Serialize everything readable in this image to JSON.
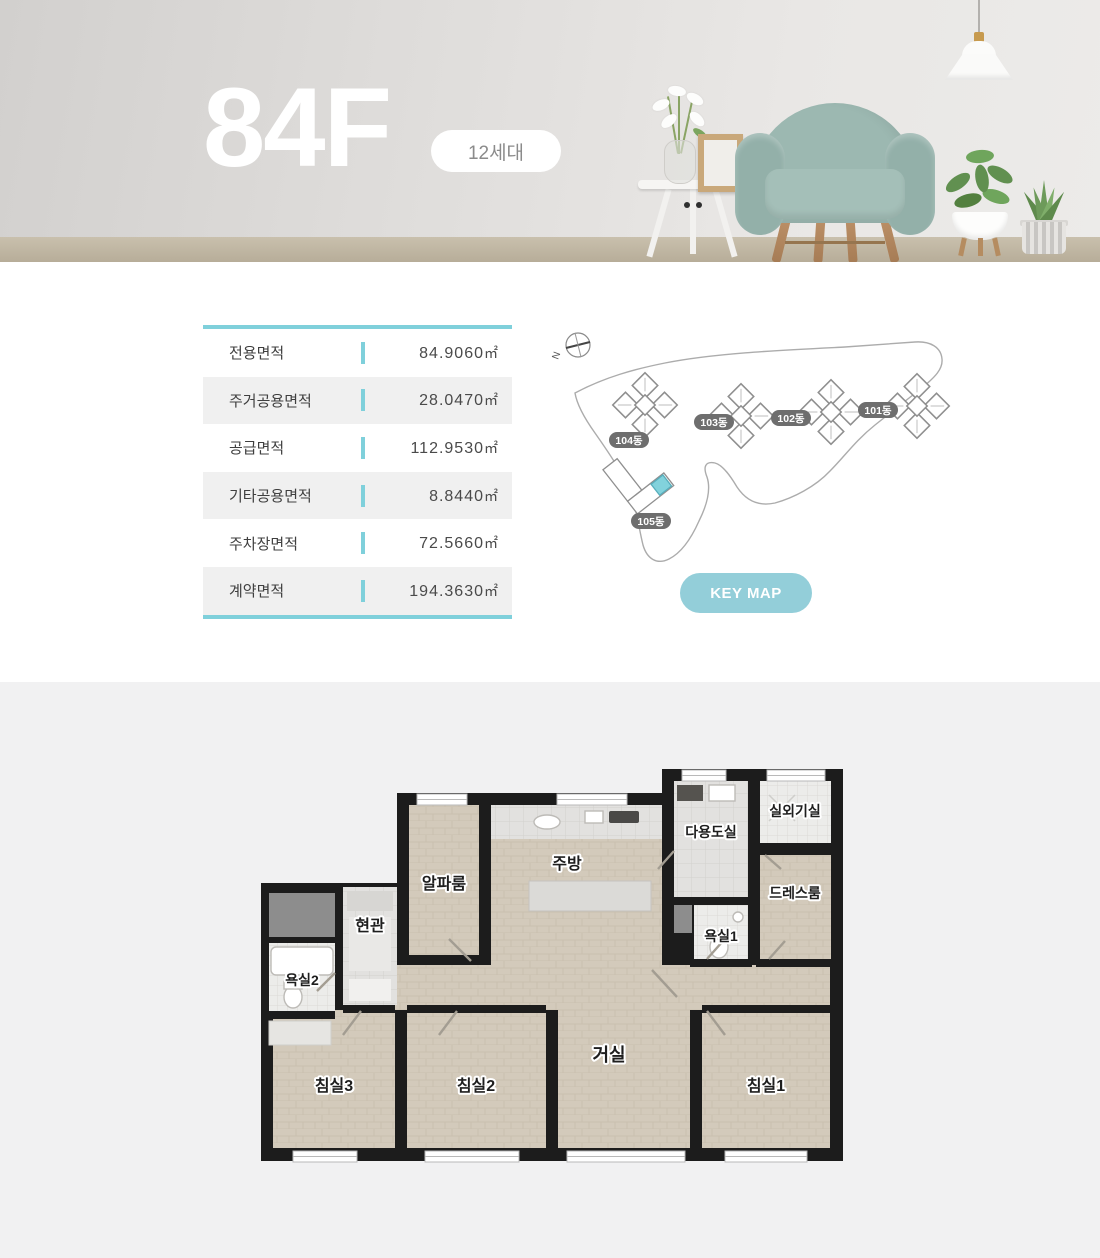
{
  "hero": {
    "title": "84F",
    "badge": "12세대",
    "decor": [
      "pendant-lamp",
      "armchair",
      "side-table",
      "vase-flowers",
      "photo-frame",
      "potted-plant",
      "aloe-plant"
    ]
  },
  "specs": {
    "rows": [
      {
        "label": "전용면적",
        "value": "84.9060",
        "unit": "㎡"
      },
      {
        "label": "주거공용면적",
        "value": "28.0470",
        "unit": "㎡"
      },
      {
        "label": "공급면적",
        "value": "112.9530",
        "unit": "㎡"
      },
      {
        "label": "기타공용면적",
        "value": "8.8440",
        "unit": "㎡"
      },
      {
        "label": "주차장면적",
        "value": "72.5660",
        "unit": "㎡"
      },
      {
        "label": "계약면적",
        "value": "194.3630",
        "unit": "㎡"
      }
    ]
  },
  "keymap": {
    "button_label": "KEY MAP",
    "compass": "N",
    "buildings": [
      "104동",
      "103동",
      "102동",
      "101동",
      "105동"
    ],
    "highlighted_building": "105동",
    "highlight_color": "#82d2dc",
    "accent_color": "#7fd0db"
  },
  "floorplan": {
    "rooms": [
      "실외기실",
      "다용도실",
      "주방",
      "알파룸",
      "드레스룸",
      "욕실1",
      "현관",
      "욕실2",
      "거실",
      "침실3",
      "침실2",
      "침실1"
    ]
  }
}
